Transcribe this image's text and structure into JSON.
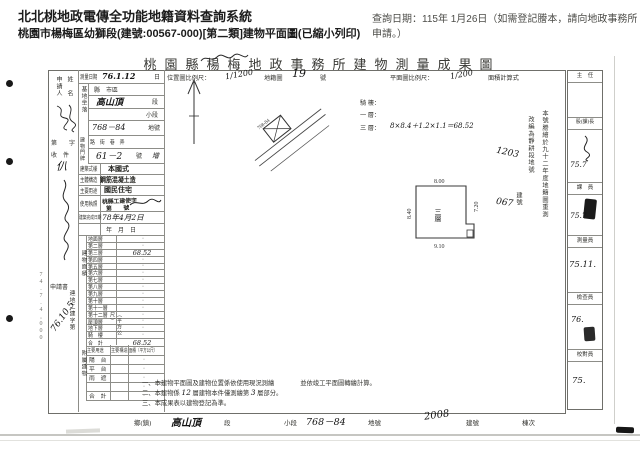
{
  "header": {
    "system_title": "北北桃地政電傳全功能地籍資料查詢系統",
    "query_date": "查詢日期：115年 1月26日（如需登記謄本，請向地政事務所申請。）",
    "doc_line": "桃園市楊梅區幼獅段(建號:00567-000)[第二類]建物平面圖(已縮小列印)"
  },
  "doc": {
    "title": "桃園縣楊梅地政事務所建物測量成果圖",
    "top_scale": {
      "loc_label": "位置圖比例尺：",
      "loc_value": "1∕1200",
      "cad_label": "地籍圖",
      "cad_no": "19",
      "cad_unit": "號",
      "plan_label": "平面圖比例尺：",
      "plan_value": "1∕200",
      "calc_label": "面積計算式"
    },
    "calc": {
      "qilou": "騎 樓：",
      "one": "一 層：",
      "three": "三 層：",
      "formula": "8×8.4＋1.2×1.1＝68.52"
    },
    "left_margin": {
      "applicant1": "申請人",
      "applicant2": "姓　名",
      "receipt_no": "第　　字",
      "receipt_hw": "仈",
      "receipt": "收　件",
      "form": "申請書",
      "file_no": "連地二建字第",
      "file_hw": "76.10.5",
      "print_note": "74.7.4,000"
    },
    "fields": {
      "survey_label": "測量日期",
      "survey_value": "76.1.12",
      "survey_unit": "日",
      "site_label": "基地坐落",
      "county": "縣　市區",
      "section_hw": "高山頂",
      "section_unit": "段",
      "subsection": "小段",
      "lot_hw": "768－84",
      "lot_unit": "地號",
      "door_label": "建物門牌",
      "door_cols": "路　街　巷　弄",
      "door_hw": "61－2",
      "door_unit": "號",
      "door_extra": "增",
      "style_label": "建築式樣",
      "style_value": "本國式",
      "structure_label": "主體構造",
      "structure_value": "鋼筋混凝土造",
      "use_label": "主要用途",
      "use_value": "國民住宅",
      "license_label": "使用執照",
      "license_stamp1": "桃縣工建使字",
      "license_stamp2": "第　　號",
      "complete_label": "建築完成日期",
      "complete_hw": "78年4月2日",
      "blank_date": "年　月　日"
    },
    "floors": {
      "label": "建物面積",
      "unit": "（平方公尺）",
      "rows": [
        {
          "n": "地面層",
          "v": "·"
        },
        {
          "n": "第二層",
          "v": "·"
        },
        {
          "n": "第三層",
          "v": "68.52"
        },
        {
          "n": "第四層",
          "v": "·"
        },
        {
          "n": "第五層",
          "v": "·"
        },
        {
          "n": "第六層",
          "v": "·"
        },
        {
          "n": "第七層",
          "v": "·"
        },
        {
          "n": "第八層",
          "v": "·"
        },
        {
          "n": "第九層",
          "v": "·"
        },
        {
          "n": "第十層",
          "v": "·"
        },
        {
          "n": "第十一層",
          "v": "·"
        },
        {
          "n": "第十二層",
          "v": "·"
        },
        {
          "n": "屋頂層",
          "v": "·"
        },
        {
          "n": "地下層",
          "v": "·"
        },
        {
          "n": "騎　樓",
          "v": "·"
        },
        {
          "n": "合　計",
          "v": "68.52"
        }
      ]
    },
    "annex": {
      "label": "附屬建物",
      "h1": "主要用途",
      "h2": "主要構造",
      "h3": "面積（平方公尺）",
      "rows": [
        {
          "n": "陽　台",
          "v": "·"
        },
        {
          "n": "平　台",
          "v": "·"
        },
        {
          "n": "雨　遮",
          "v": "·"
        },
        {
          "n": "",
          "v": "·"
        },
        {
          "n": "合　計",
          "v": "·"
        }
      ]
    },
    "plan": {
      "floor": "三層",
      "top": "8.00",
      "left": "8.40",
      "right": "7.20",
      "bottom": "9.10"
    },
    "sketch": {
      "lot": "768-84"
    },
    "remeasure": {
      "col1": "本號謄繪於九十二年度地籍圖重測",
      "col2": "改編為靜耕段地號",
      "hw1": "1203",
      "hw2": "067",
      "col3": "建號"
    },
    "notes": {
      "n1a": "一、本建物平面圖及建物位置係依使用現況測繪",
      "n1b": "並依竣工平面圖轉繪計算。",
      "n2a": "二、本建物係",
      "n2hw1": "12",
      "n2b": "層建物本件僅測繪第",
      "n2hw2": "3",
      "n2c": "層部分。",
      "n3": "三、本成果表以建物登記為準。"
    },
    "footer": {
      "town": "鄉(鎮)",
      "section_hw": "高山頂",
      "section": "段",
      "subsection": "小段",
      "lot_hw": "768－84",
      "lot": "地號",
      "bldg_hw": "2008",
      "bldg": "建號",
      "unit": "棟次"
    },
    "approval": {
      "rows": [
        {
          "t": "主　任",
          "s": ""
        },
        {
          "t": "股(課)長",
          "s": "75.7"
        },
        {
          "t": "課　員",
          "s": "75.7"
        },
        {
          "t": "測量員",
          "s": "75.11."
        },
        {
          "t": "檢查員",
          "s": "76."
        },
        {
          "t": "校對員",
          "s": "75."
        }
      ]
    }
  }
}
